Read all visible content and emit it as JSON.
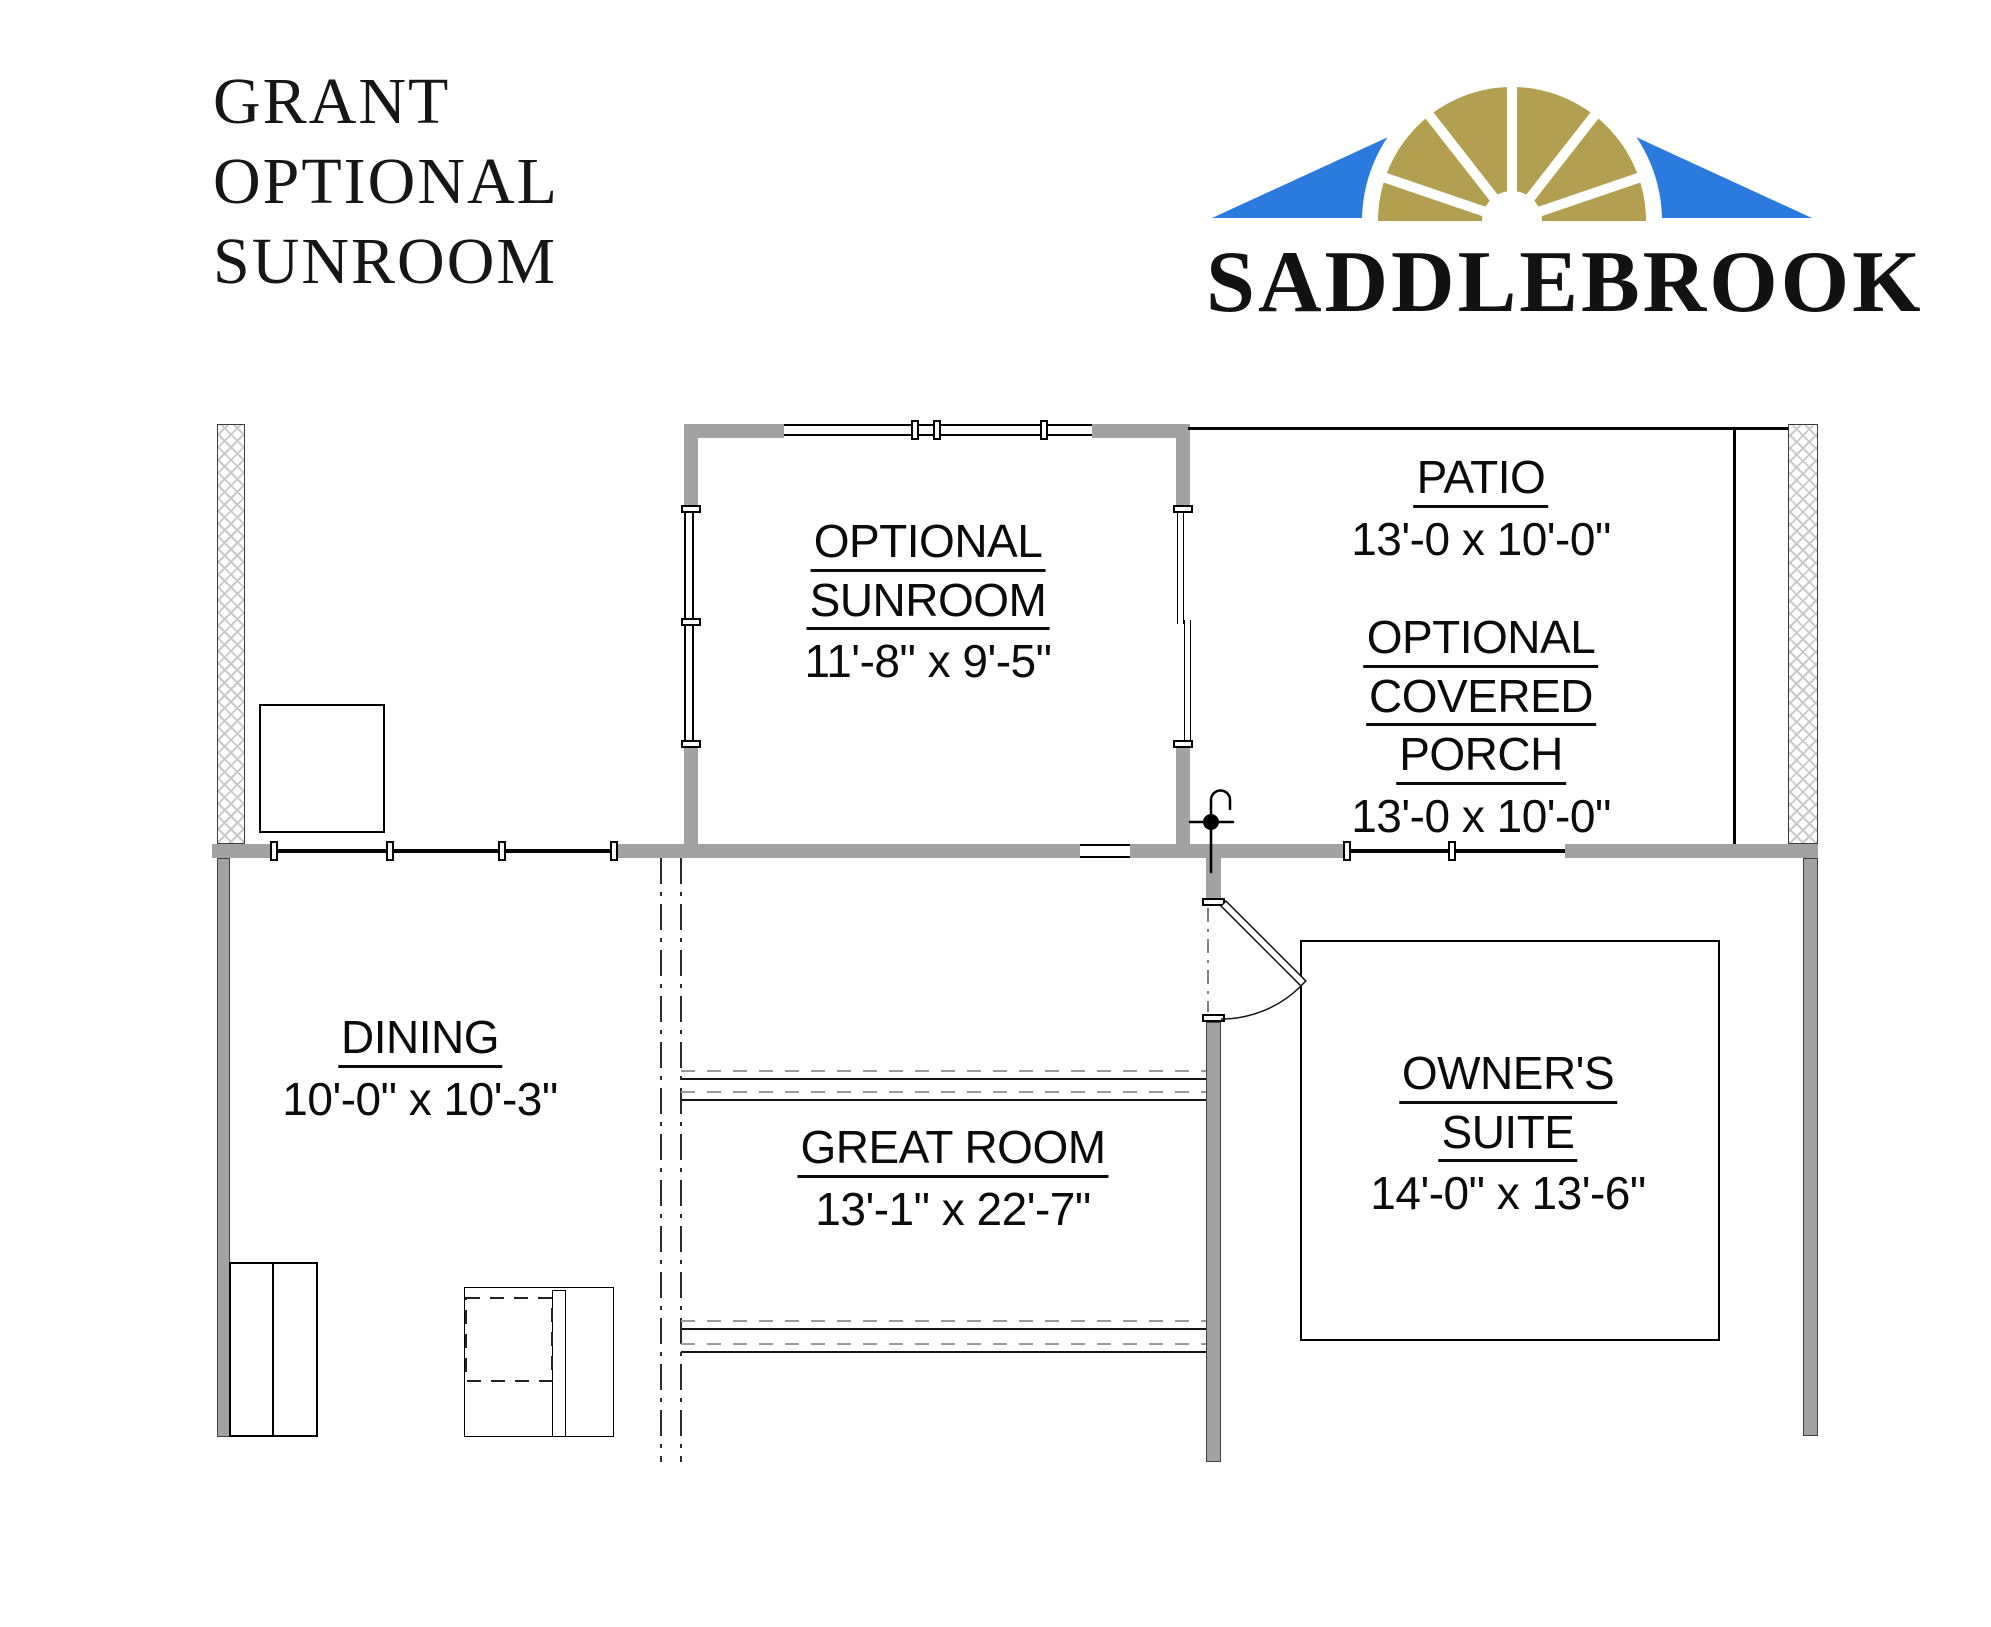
{
  "title": {
    "line1": "GRANT",
    "line2": "OPTIONAL",
    "line3": "SUNROOM"
  },
  "logo": {
    "brand": "SADDLEBROOK",
    "roof_blue": "#2b7ade",
    "fan_gold": "#b29f50"
  },
  "rooms": {
    "sunroom": {
      "line1": "OPTIONAL",
      "line2": "SUNROOM",
      "dims": "11'-8\" x 9'-5\""
    },
    "patio": {
      "line1": "PATIO",
      "dims": "13'-0 x 10'-0\""
    },
    "porch": {
      "line1": "OPTIONAL",
      "line2": "COVERED",
      "line3": "PORCH",
      "dims": "13'-0 x 10'-0\""
    },
    "dining": {
      "line1": "DINING",
      "dims": "10'-0\" x 10'-3\""
    },
    "great_room": {
      "line1": "GREAT ROOM",
      "dims": "13'-1\" x 22'-7\""
    },
    "owners_suite": {
      "line1": "OWNER'S",
      "line2": "SUITE",
      "dims": "14'-0\" x 13'-6\""
    }
  }
}
